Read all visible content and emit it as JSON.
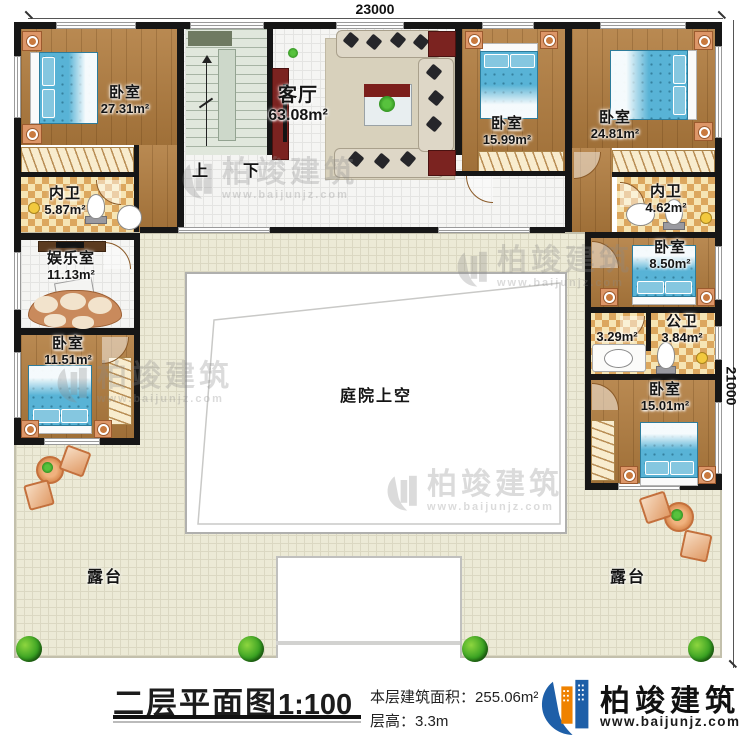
{
  "dimensions": {
    "top": "23000",
    "right": "21000"
  },
  "stairs": {
    "up": "上",
    "down": "下"
  },
  "rooms": {
    "bedroom_tl": {
      "label": "卧室",
      "area": "27.31m²"
    },
    "neiwei_l": {
      "label": "内卫",
      "area": "5.87m²"
    },
    "living": {
      "label": "客厅",
      "area": "63.08m²"
    },
    "bedroom_tm": {
      "label": "卧室",
      "area": "15.99m²"
    },
    "bedroom_tr": {
      "label": "卧室",
      "area": "24.81m²"
    },
    "neiwei_r": {
      "label": "内卫",
      "area": "4.62m²"
    },
    "entertainment": {
      "label": "娱乐室",
      "area": "11.13m²"
    },
    "bedroom_l": {
      "label": "卧室",
      "area": "11.51m²"
    },
    "bedroom_r1": {
      "label": "卧室",
      "area": "8.50m²"
    },
    "gongwei": {
      "label": "公卫",
      "area": "3.84m²",
      "ante_area": "3.29m²"
    },
    "bedroom_r2": {
      "label": "卧室",
      "area": "15.01m²"
    },
    "courtyard": {
      "label": "庭院上空"
    },
    "terrace_left": {
      "label": "露台"
    },
    "terrace_right": {
      "label": "露台"
    }
  },
  "footer": {
    "title": "二层平面图",
    "scale": "1:100",
    "area_label": "本层建筑面积：",
    "area_value": "255.06m²",
    "floor_height_label": "层高：",
    "floor_height_value": "3.3m",
    "brand": "柏竣建筑",
    "website": "www.baijunjz.com"
  },
  "watermark": {
    "brand": "柏竣建筑",
    "website": "www.baijunjz.com"
  },
  "colors": {
    "wall": "#161616",
    "wood": "#b17c3e",
    "bath_tile": "#f6e5b4",
    "terrace": "#ecead6",
    "bed": "#58b3d6",
    "brand_blue": "#1e5fa8",
    "brand_orange": "#ef8200"
  }
}
